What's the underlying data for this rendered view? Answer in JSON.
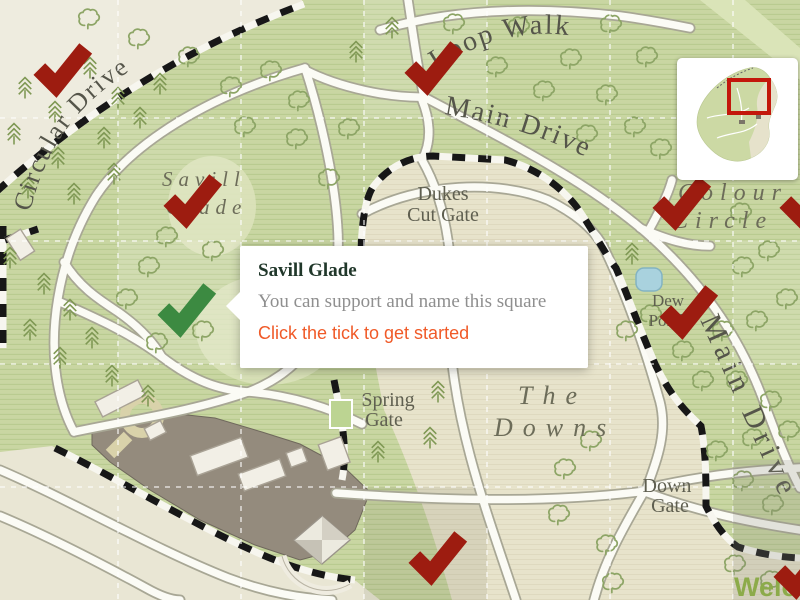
{
  "map": {
    "road_labels": {
      "circular_drive": "Circular Drive",
      "loop_walk": "Loop Walk",
      "main_drive_top": "Main Drive",
      "main_drive_right": "Main Drive"
    },
    "area_labels": {
      "savill_glade": [
        "Savill",
        "Glade"
      ],
      "colour_circle": [
        "Colour",
        "Circle"
      ],
      "the_downs": [
        "The",
        "Downs"
      ],
      "dew_pond": [
        "Dew",
        "Pond"
      ]
    },
    "gate_labels": {
      "dukes_cut_gate": [
        "Dukes",
        "Cut Gate"
      ],
      "spring_gate": [
        "Spring",
        "Gate"
      ],
      "down_gate": [
        "Down",
        "Gate"
      ]
    },
    "welcome_partial": "Welco",
    "marker_colors": {
      "available": "#9d1c10",
      "selected": "#3c8a41"
    },
    "markers": [
      {
        "x": 62,
        "y": 66,
        "state": "available"
      },
      {
        "x": 192,
        "y": 197,
        "state": "available"
      },
      {
        "x": 433,
        "y": 64,
        "state": "available"
      },
      {
        "x": 681,
        "y": 199,
        "state": "available"
      },
      {
        "x": 808,
        "y": 199,
        "state": "available"
      },
      {
        "x": 688,
        "y": 308,
        "state": "available"
      },
      {
        "x": 437,
        "y": 554,
        "state": "available"
      },
      {
        "x": 802,
        "y": 568,
        "state": "available"
      },
      {
        "x": 186,
        "y": 306,
        "state": "selected"
      }
    ]
  },
  "tooltip": {
    "title": "Savill Glade",
    "body": "You can support and name this square",
    "cta": "Click the tick to get started"
  },
  "minimap": {
    "viewport": {
      "x": 52,
      "y": 22,
      "w": 40,
      "h": 33
    }
  },
  "colors": {
    "tick_red": "#9d1c10",
    "tick_green": "#3c8a41",
    "cta_orange": "#f05a28",
    "minimap_viewport_red": "#c3170b",
    "welcome_green": "#8cab4a"
  }
}
